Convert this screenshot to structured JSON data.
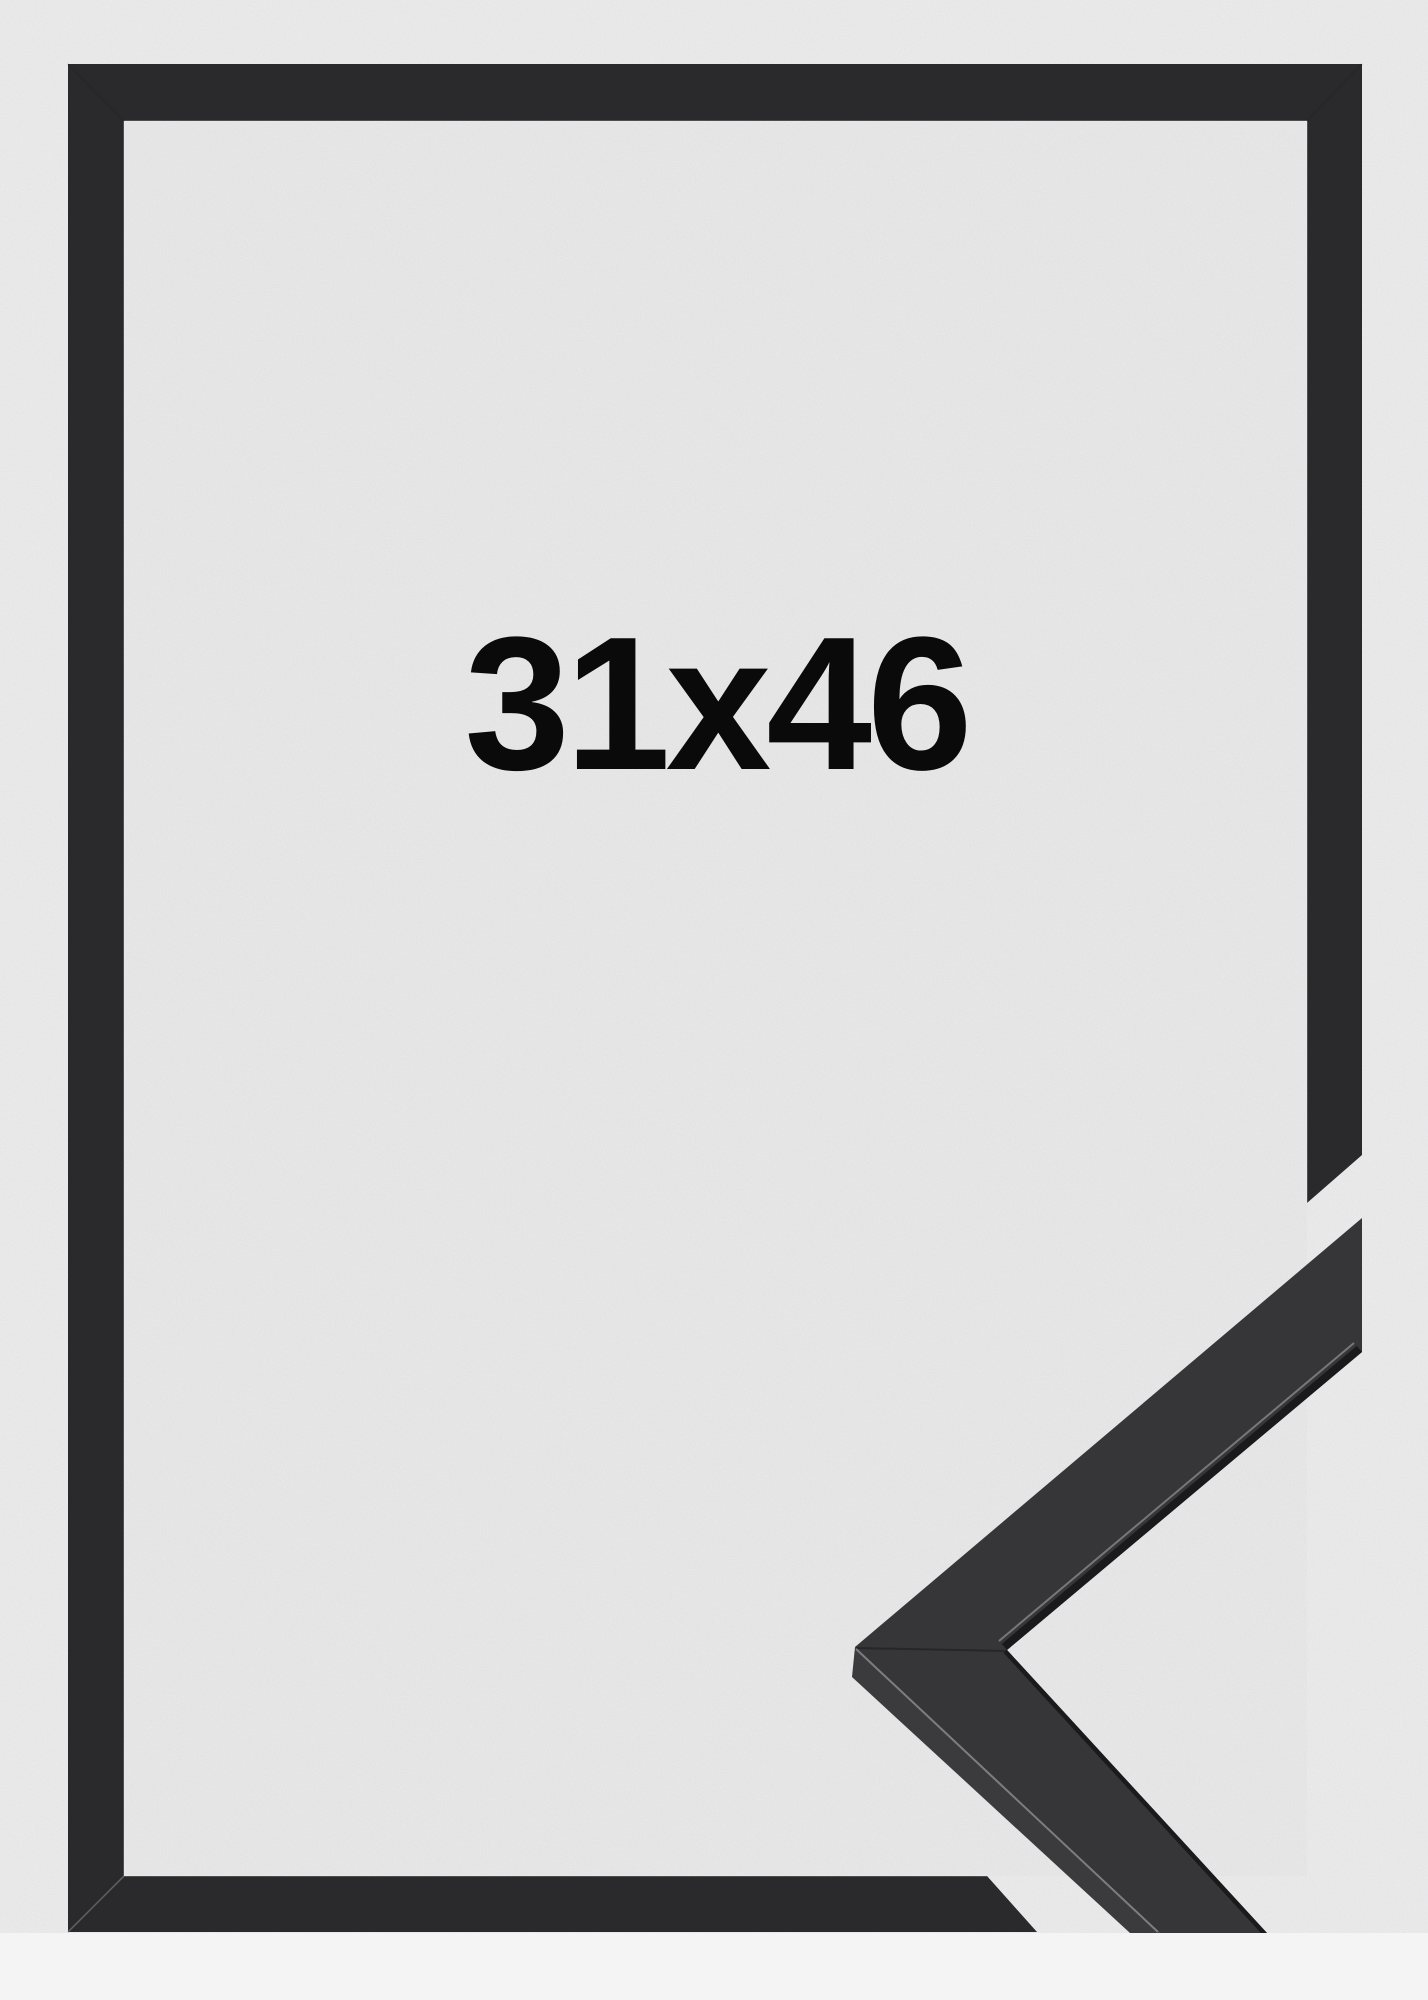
{
  "product": {
    "size_label": "31x46"
  },
  "colors": {
    "page_bg": "#f4f4f5",
    "photo_bg": "#f3f3f4",
    "inner_bg": "#f0f0f1",
    "frame_dark": "#2c2c2e",
    "sample_face": "#39393b",
    "sample_side": "#3e3e41",
    "edge_dark": "#1c1c1e",
    "edge_light": "#9a9a9d",
    "text": "#0a0a0b"
  }
}
